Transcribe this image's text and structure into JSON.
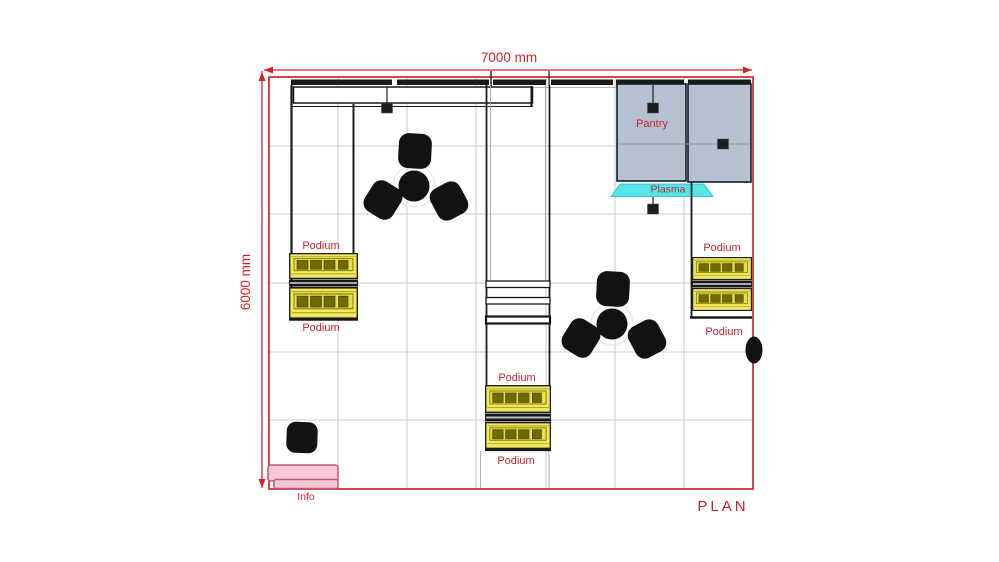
{
  "plan": {
    "title": "PLAN",
    "width_dim": "7000 mm",
    "height_dim": "6000 mm"
  },
  "labels": {
    "pantry": "Pantry",
    "plasma": "Plasma",
    "podium": "Podium",
    "info": "Info"
  },
  "icons": {
    "ceiling_light": "ceiling-light-icon",
    "chair": "chair-icon",
    "round_table": "round-table-icon"
  },
  "colors": {
    "dimension_red": "#cf2728",
    "label_red": "#c4232f",
    "wall_black": "#1a1a1a",
    "grid_gray": "#cbcbcb",
    "podium_yellow": "#f2e95e",
    "podium_band_yellow": "#e8dd4a",
    "podium_drawer_olive": "#6e6a00",
    "pantry_blue": "#b5c1d1",
    "plasma_cyan": "#55e5e8",
    "info_pink": "#f9c6da",
    "info_border": "#b85a7a",
    "furniture_black": "#121212"
  }
}
